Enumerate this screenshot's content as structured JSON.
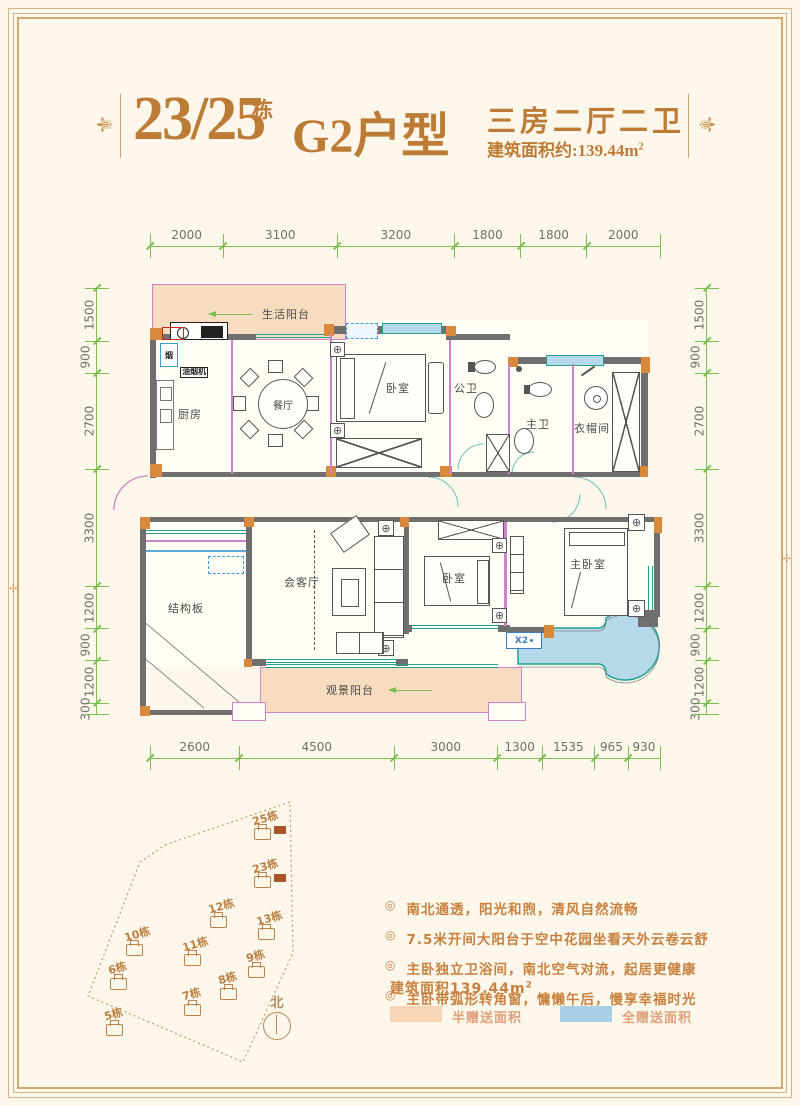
{
  "header": {
    "block_no": "23/25",
    "block_unit": "栋",
    "type_name": "G2户型",
    "rooms_line": "三房二厅二卫",
    "area_line": "建筑面积约:139.44m",
    "area_sup": "2"
  },
  "dimensions": {
    "top": [
      "2000",
      "3100",
      "3200",
      "1800",
      "1800",
      "2000"
    ],
    "bottom": [
      "2600",
      "4500",
      "3000",
      "1300",
      "1535",
      "965",
      "930"
    ],
    "left": [
      "1500",
      "900",
      "2700",
      "3300",
      "1200",
      "900",
      "1200",
      "300"
    ],
    "right": [
      "1500",
      "900",
      "2700",
      "3300",
      "1200",
      "900",
      "1200",
      "300"
    ]
  },
  "plan": {
    "rooms": {
      "life_balcony": "生活阳台",
      "kitchen": "厨房",
      "dining": "餐厅",
      "bedroom_top": "卧室",
      "public_bath": "公卫",
      "master_bath": "主卫",
      "cloakroom": "衣帽间",
      "structure_board": "结构板",
      "living": "会客厅",
      "bedroom2": "卧室",
      "master_bedroom": "主卧室",
      "view_balcony": "观景阳台"
    },
    "labels": {
      "hood": "油烟机",
      "flue": "烟",
      "x2": "X2"
    }
  },
  "site_map": {
    "north_label": "北",
    "buildings": [
      {
        "name": "25栋",
        "x": 252,
        "y": 810,
        "hl": true
      },
      {
        "name": "23栋",
        "x": 252,
        "y": 858,
        "hl": true
      },
      {
        "name": "12栋",
        "x": 208,
        "y": 898,
        "hl": false
      },
      {
        "name": "13栋",
        "x": 256,
        "y": 910,
        "hl": false
      },
      {
        "name": "10栋",
        "x": 124,
        "y": 926,
        "hl": false
      },
      {
        "name": "11栋",
        "x": 182,
        "y": 936,
        "hl": false
      },
      {
        "name": "9栋",
        "x": 246,
        "y": 948,
        "hl": false
      },
      {
        "name": "6栋",
        "x": 108,
        "y": 960,
        "hl": false
      },
      {
        "name": "8栋",
        "x": 218,
        "y": 970,
        "hl": false
      },
      {
        "name": "7栋",
        "x": 182,
        "y": 986,
        "hl": false
      },
      {
        "name": "5栋",
        "x": 104,
        "y": 1006,
        "hl": false
      }
    ]
  },
  "notes": {
    "bullets": [
      "南北通透，阳光和煦，清风自然流畅",
      "7.5米开间大阳台于空中花园坐看天外云卷云舒",
      "主卧独立卫浴间，南北空气对流，起居更健康",
      "主卧带弧形转角窗，慵懒午后，慢享幸福时光"
    ],
    "area_line": "建筑面积139.44m",
    "area_sup": "2",
    "legend": [
      {
        "label": "半赠送面积",
        "color": "#f7d4b6"
      },
      {
        "label": "全赠送面积",
        "color": "#a9cfe7"
      }
    ]
  },
  "colors": {
    "accent_gold": "#bd7c36",
    "dim_green": "#7cbf4e",
    "wall_gray": "#6f6f6f",
    "wall_orange": "#d8893b",
    "partition_pink": "#cc85c9",
    "window_teal": "#1fa28e",
    "glazing_blue": "#b5d8ea",
    "gift_peach": "#f7dcc0"
  }
}
